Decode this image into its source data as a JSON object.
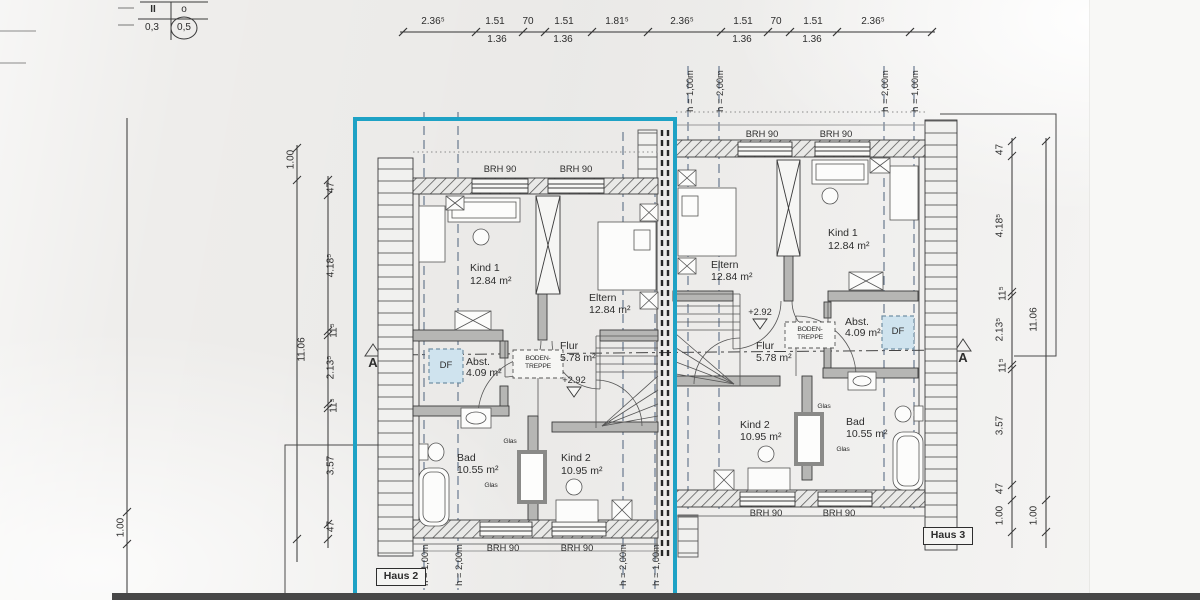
{
  "ref_table": {
    "h1": "II",
    "h2": "o",
    "v1": "0,3",
    "v2": "0,5"
  },
  "top_dims": {
    "upper": [
      "2.36⁵",
      "1.51",
      "70",
      "1.51",
      "1.81⁵",
      "2.36⁵",
      "1.51",
      "70",
      "1.51",
      "2.36⁵"
    ],
    "lower": [
      "1.36",
      "1.36",
      "1.36",
      "1.36"
    ]
  },
  "left_dims": {
    "offset_top": "1.00",
    "overall": "11.06",
    "segments": [
      "47",
      "4.18⁵",
      "11⁵",
      "2.13⁵",
      "11⁵",
      "3.57",
      "47"
    ],
    "ground": "1.00"
  },
  "right_dims": {
    "overall": "11.06",
    "segments": [
      "47",
      "4.18⁵",
      "11⁵",
      "2.13⁵",
      "11⁵",
      "3.57",
      "47"
    ],
    "inner_bottom": "1.00",
    "outer_bottom": "1.00"
  },
  "section_markers": {
    "left": "A",
    "right": "A"
  },
  "haus2": {
    "name": "Haus 2",
    "rooms": {
      "kind1": {
        "name": "Kind 1",
        "area": "12.84 m²"
      },
      "eltern": {
        "name": "Eltern",
        "area": "12.84 m²"
      },
      "flur": {
        "name": "Flur",
        "area": "5.78 m²"
      },
      "abst": {
        "name": "Abst.",
        "area": "4.09 m²"
      },
      "bad": {
        "name": "Bad",
        "area": "10.55 m²"
      },
      "kind2": {
        "name": "Kind 2",
        "area": "10.95 m²"
      }
    },
    "df": "DF",
    "boden1": "BODEN-",
    "boden2": "TREPPE",
    "level": "+2.92",
    "glas1": "Glas",
    "glas2": "Glas",
    "brh_top": [
      "BRH 90",
      "BRH 90"
    ],
    "brh_bottom": [
      "BRH 90",
      "BRH 90"
    ],
    "h_labels": [
      "h = 1,00m",
      "h = 2,00m",
      "h = 2,00m",
      "h = 1,00m"
    ]
  },
  "haus3": {
    "name": "Haus 3",
    "rooms": {
      "eltern": {
        "name": "Eltern",
        "area": "12.84 m²"
      },
      "kind1": {
        "name": "Kind 1",
        "area": "12.84 m²"
      },
      "flur": {
        "name": "Flur",
        "area": "5.78 m²"
      },
      "abst": {
        "name": "Abst.",
        "area": "4.09 m²"
      },
      "kind2": {
        "name": "Kind 2",
        "area": "10.95 m²"
      },
      "bad": {
        "name": "Bad",
        "area": "10.55 m²"
      }
    },
    "df": "DF",
    "boden1": "BODEN-",
    "boden2": "TREPPE",
    "level": "+2.92",
    "glas1": "Glas",
    "glas2": "Glas",
    "brh_top": [
      "BRH 90",
      "BRH 90"
    ],
    "brh_bottom": [
      "BRH 90",
      "BRH 90"
    ],
    "h_labels": [
      "h = 1,00m",
      "h = 2,00m",
      "h = 2,00m",
      "h = 1,00m"
    ]
  },
  "colors": {
    "highlight": "#1ea2c5",
    "df_fill": "#cfe3ee"
  }
}
